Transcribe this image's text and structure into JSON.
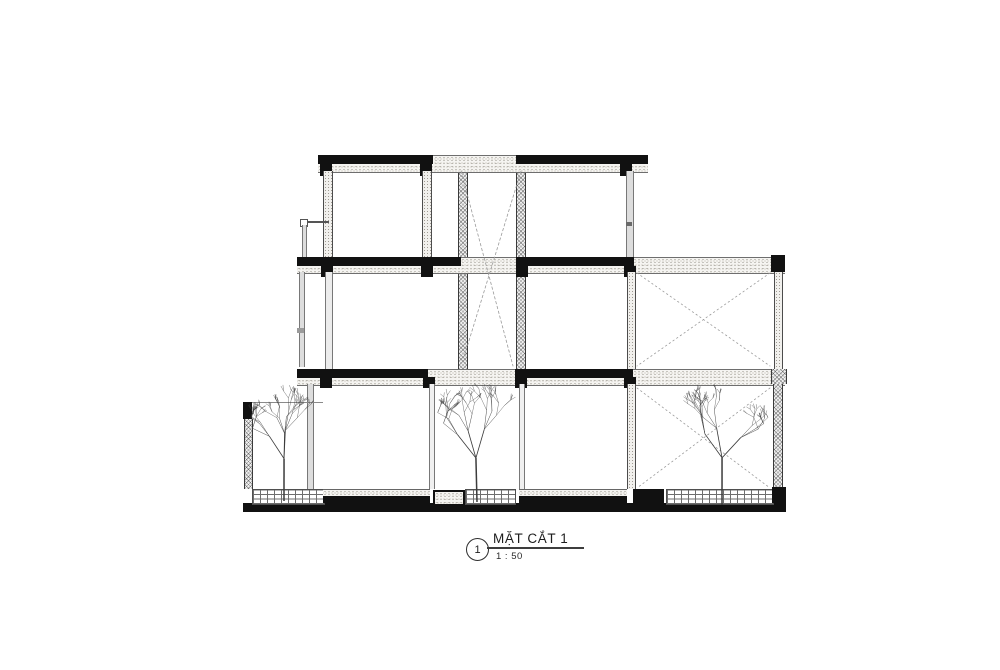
{
  "title_block": {
    "detail_number": "1",
    "title": "MẶT CẮT 1",
    "scale": "1 : 50"
  },
  "colors": {
    "ink": "#111111",
    "hatch_line": "#3a3a3a",
    "dashed_line": "#9a9a9a",
    "tree_line": "#3c3c3c"
  },
  "drawing": {
    "dashed_lines": [
      {
        "x1": 461,
        "y1": 171,
        "x2": 513,
        "y2": 366,
        "dash": "2.5 2.5"
      },
      {
        "x1": 521,
        "y1": 171,
        "x2": 464,
        "y2": 357,
        "dash": "2.5 2.5"
      },
      {
        "x1": 637,
        "y1": 273,
        "x2": 770,
        "y2": 366,
        "dash": "1.5 3"
      },
      {
        "x1": 770,
        "y1": 273,
        "x2": 637,
        "y2": 366,
        "dash": "1.5 3"
      },
      {
        "x1": 637,
        "y1": 388,
        "x2": 770,
        "y2": 488,
        "dash": "1.5 3"
      },
      {
        "x1": 770,
        "y1": 388,
        "x2": 637,
        "y2": 488,
        "dash": "1.5 3"
      }
    ],
    "trees": [
      {
        "cx": 284,
        "base": 501,
        "height": 106,
        "spread": 37,
        "seed": 11
      },
      {
        "cx": 477,
        "base": 502,
        "height": 110,
        "spread": 40,
        "seed": 23
      },
      {
        "cx": 722,
        "base": 505,
        "height": 118,
        "spread": 46,
        "seed": 37
      }
    ]
  }
}
